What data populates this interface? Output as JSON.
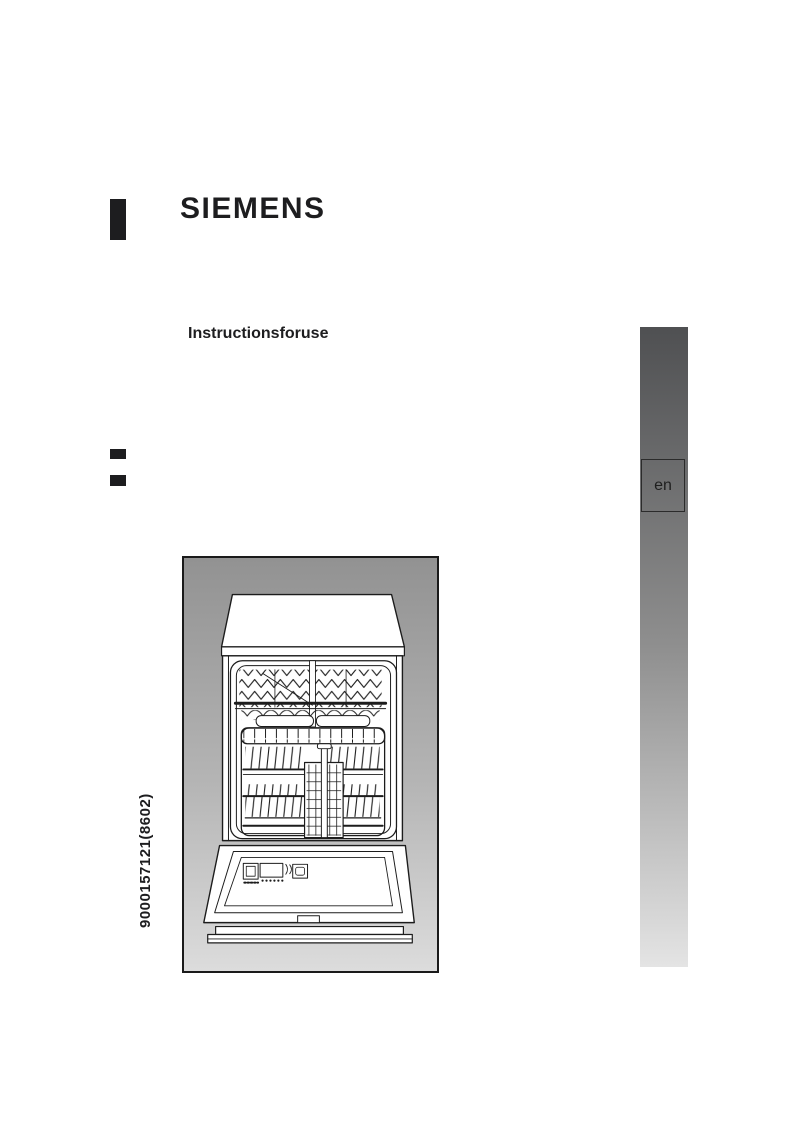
{
  "page": {
    "type": "instruction-manual-cover",
    "background_color": "#ffffff"
  },
  "brand": {
    "logo_text": "SIEMENS",
    "color": "#1d1d1f"
  },
  "title": {
    "subtitle": "Instructionsforuse"
  },
  "language_bar": {
    "label": "en",
    "gradient_top": "#4f5052",
    "gradient_bottom": "#e4e4e4",
    "box_border_color": "#2b2b2b"
  },
  "illustration": {
    "name": "dishwasher-front-open",
    "background_top": "#929292",
    "background_bottom": "#dcdcdc",
    "line_color": "#1c1c1c",
    "frame_border_color": "#1a1a1a"
  },
  "document_number": "9000157121(8602)"
}
